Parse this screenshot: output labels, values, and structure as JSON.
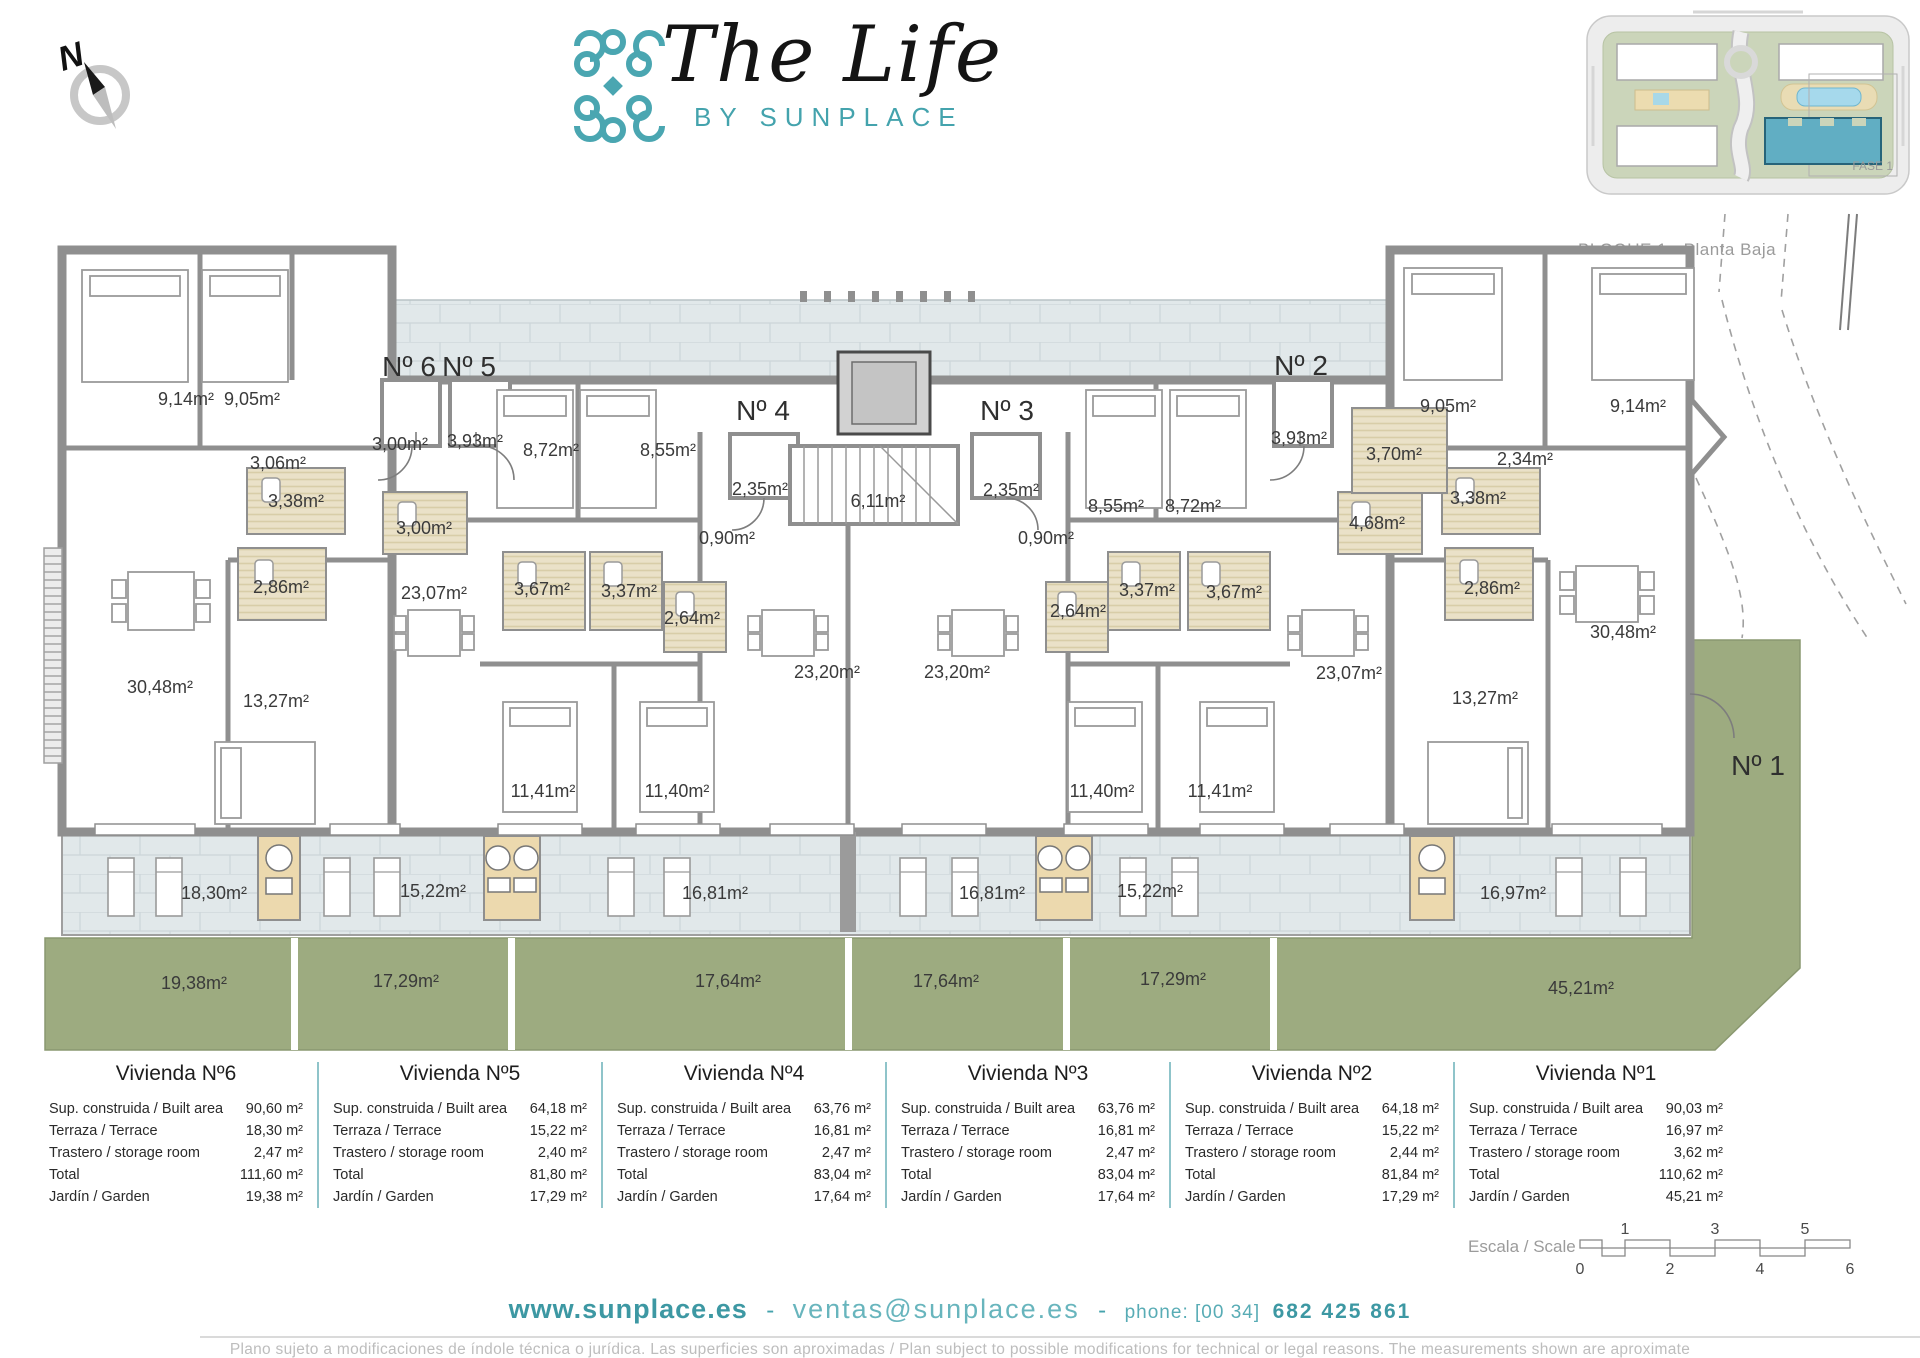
{
  "header": {
    "compass_n": "N",
    "brand_title": "The Life",
    "brand_subtitle": "BY SUNPLACE",
    "inset": {
      "fase_label": "FASE 1",
      "caption": "BLOQUE 1 - Planta Baja"
    }
  },
  "plan": {
    "unit_door_labels": [
      {
        "name": "unit-6",
        "label": "Nº 6"
      },
      {
        "name": "unit-5",
        "label": "Nº 5"
      },
      {
        "name": "unit-4",
        "label": "Nº 4"
      },
      {
        "name": "unit-3",
        "label": "Nº 3"
      },
      {
        "name": "unit-2",
        "label": "Nº 2"
      },
      {
        "name": "unit-1",
        "label": "Nº 1"
      }
    ],
    "rooms": [
      {
        "name": "n6-bedroom-1",
        "label": "9,14m²"
      },
      {
        "name": "n6-bedroom-2",
        "label": "9,05m²"
      },
      {
        "name": "n6-hall",
        "label": "3,06m²"
      },
      {
        "name": "n6-bath-1",
        "label": "3,38m²"
      },
      {
        "name": "n6-bath-2",
        "label": "2,86m²"
      },
      {
        "name": "n6-living",
        "label": "30,48m²"
      },
      {
        "name": "n6-bedroom-3",
        "label": "13,27m²"
      },
      {
        "name": "n6-porch",
        "label": "3,00m²"
      },
      {
        "name": "n5-porch",
        "label": "3,93m²"
      },
      {
        "name": "n5-bath-3",
        "label": "3,00m²"
      },
      {
        "name": "n5-living",
        "label": "23,07m²"
      },
      {
        "name": "n5-bedroom-1",
        "label": "8,72m²"
      },
      {
        "name": "n5-bedroom-2",
        "label": "8,55m²"
      },
      {
        "name": "n5-bath-1",
        "label": "3,67m²"
      },
      {
        "name": "n5-bath-2",
        "label": "3,37m²"
      },
      {
        "name": "n5-bedroom-3",
        "label": "11,41m²"
      },
      {
        "name": "n5-bedroom-4",
        "label": "11,40m²"
      },
      {
        "name": "n4-porch",
        "label": "2,35m²"
      },
      {
        "name": "n4-hall",
        "label": "0,90m²"
      },
      {
        "name": "n4-bath",
        "label": "2,64m²"
      },
      {
        "name": "n4-living",
        "label": "23,20m²"
      },
      {
        "name": "stairwell",
        "label": "6,11m²"
      },
      {
        "name": "n3-living",
        "label": "23,20m²"
      },
      {
        "name": "n3-porch",
        "label": "2,35m²"
      },
      {
        "name": "n3-hall",
        "label": "0,90m²"
      },
      {
        "name": "n3-bath-1",
        "label": "2,64m²"
      },
      {
        "name": "n3-bath-2",
        "label": "3,37m²"
      },
      {
        "name": "n3-bath-3",
        "label": "3,67m²"
      },
      {
        "name": "n3-bedroom-1",
        "label": "8,55m²"
      },
      {
        "name": "n3-bedroom-2",
        "label": "8,72m²"
      },
      {
        "name": "n3-bedroom-3",
        "label": "11,40m²"
      },
      {
        "name": "n3-bedroom-4",
        "label": "11,41m²"
      },
      {
        "name": "n2-porch",
        "label": "3,93m²"
      },
      {
        "name": "n2-kitchen",
        "label": "3,70m²"
      },
      {
        "name": "n2-bedroom-1",
        "label": "9,05m²"
      },
      {
        "name": "n2-bedroom-2",
        "label": "9,14m²"
      },
      {
        "name": "n2-hall",
        "label": "2,34m²"
      },
      {
        "name": "n2-bath-1",
        "label": "4,68m²"
      },
      {
        "name": "n2-bath-2",
        "label": "3,38m²"
      },
      {
        "name": "n2-bath-3",
        "label": "2,86m²"
      },
      {
        "name": "n2-living",
        "label": "23,07m²"
      },
      {
        "name": "n1-living",
        "label": "30,48m²"
      },
      {
        "name": "n1-bedroom",
        "label": "13,27m²"
      },
      {
        "name": "terrace-n6",
        "label": "18,30m²"
      },
      {
        "name": "terrace-n5",
        "label": "15,22m²"
      },
      {
        "name": "terrace-n4",
        "label": "16,81m²"
      },
      {
        "name": "terrace-n3",
        "label": "16,81m²"
      },
      {
        "name": "terrace-n2",
        "label": "15,22m²"
      },
      {
        "name": "terrace-n1",
        "label": "16,97m²"
      },
      {
        "name": "garden-n6",
        "label": "19,38m²"
      },
      {
        "name": "garden-n5",
        "label": "17,29m²"
      },
      {
        "name": "garden-n4",
        "label": "17,64m²"
      },
      {
        "name": "garden-n3",
        "label": "17,64m²"
      },
      {
        "name": "garden-n2",
        "label": "17,29m²"
      },
      {
        "name": "garden-n1",
        "label": "45,21m²"
      }
    ]
  },
  "summary_table": {
    "row_labels": [
      "Sup. construida / Built area",
      "Terraza / Terrace",
      "Trastero / storage room",
      "Total",
      "Jardín / Garden"
    ],
    "units": [
      {
        "title": "Vivienda Nº6",
        "values": [
          "90,60 m²",
          "18,30 m²",
          "2,47 m²",
          "111,60 m²",
          "19,38 m²"
        ]
      },
      {
        "title": "Vivienda Nº5",
        "values": [
          "64,18 m²",
          "15,22 m²",
          "2,40 m²",
          "81,80 m²",
          "17,29 m²"
        ]
      },
      {
        "title": "Vivienda Nº4",
        "values": [
          "63,76 m²",
          "16,81 m²",
          "2,47 m²",
          "83,04 m²",
          "17,64 m²"
        ]
      },
      {
        "title": "Vivienda Nº3",
        "values": [
          "63,76 m²",
          "16,81 m²",
          "2,47 m²",
          "83,04 m²",
          "17,64 m²"
        ]
      },
      {
        "title": "Vivienda Nº2",
        "values": [
          "64,18 m²",
          "15,22 m²",
          "2,44 m²",
          "81,84 m²",
          "17,29 m²"
        ]
      },
      {
        "title": "Vivienda Nº1",
        "values": [
          "90,03 m²",
          "16,97 m²",
          "3,62 m²",
          "110,62 m²",
          "45,21 m²"
        ]
      }
    ]
  },
  "scale": {
    "label": "Escala / Scale",
    "top_ticks": [
      "1",
      "3",
      "5"
    ],
    "bottom_ticks": [
      "0",
      "2",
      "4",
      "6"
    ]
  },
  "footer": {
    "website": "www.sunplace.es",
    "separator": "-",
    "email": "ventas@sunplace.es",
    "separator2": "-",
    "phone_label": "phone: [00 34]",
    "phone_number": "682 425 861",
    "disclaimer": "Plano sujeto a modificaciones de índole técnica o jurídica. Las superficies son aproximadas / Plan subject to possible modifications for technical or legal reasons. The measurements shown are aproximate"
  },
  "colors": {
    "teal": "#45a3ad",
    "wall_gray": "#8f8f8f",
    "garden_green": "#9dab80",
    "terrace_tile": "#e1e8ea",
    "storage_beige": "#ecd9ae"
  }
}
